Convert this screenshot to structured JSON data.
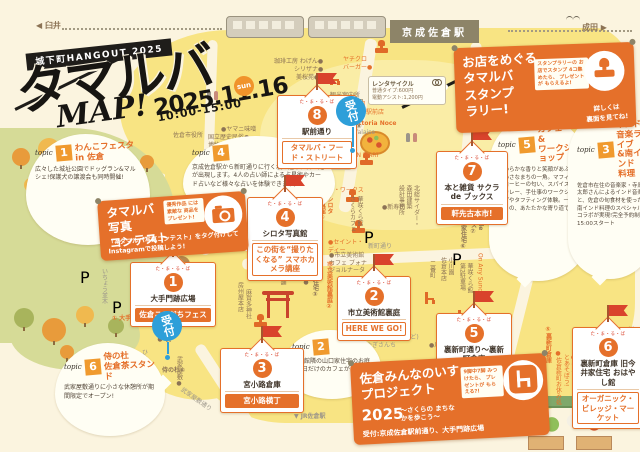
{
  "colors": {
    "accent_orange": "#E5702A",
    "flag_red": "#D9432C",
    "reception_blue": "#2E9FD9",
    "map_yellow": "#F8E483",
    "park_green": "#D6DB97",
    "station_khaki": "#8D8468",
    "ink": "#171512"
  },
  "header": {
    "badge": "城下町HANGOUT 2025",
    "title": "タマルバ",
    "map_word": "MAP!",
    "date": "2025.11.16",
    "day": "sun",
    "time": "10:00-15:00"
  },
  "stations": {
    "left": "◀ 臼井",
    "right": "成田 ▶",
    "keisei": "京成佐倉駅",
    "jr": "▼ JR佐倉駅"
  },
  "reception_label": "受付",
  "p_label": "P",
  "rental": {
    "title": "レンタサイクル",
    "line1": "普通タイプ:600円",
    "line2": "電動アシスト:1,200円"
  },
  "route_shield": "296",
  "stamp_rally": {
    "title": "お店をめぐる\nタマルバ\nスタンプ\nラリー!",
    "note": "スタンプラリーの\nお店でスタンプ\n4コ集めたら、\nプレゼントが\nもらえるよ!",
    "footer": "詳しくは\n裏面を見てね!"
  },
  "photo_contest": {
    "title": "タマルバ\n写真\nコンテスト",
    "note": "優秀作品\nには素敵な\n商品を\nプレゼント!",
    "body": "「#タマルバ写真コンテスト」をタグ付けしてInstagramで投稿しよう!"
  },
  "chair_project": {
    "title": "佐倉みんなのいす\nプロジェクト",
    "year": "2025",
    "sub": "〜さくらの\nまちなかを歩こう〜",
    "note": "9脚中7脚\nみつけたら、\nプレゼントが\nもらえる?!",
    "reception": "受付:京成佐倉駅前通り、大手門跡広場"
  },
  "venues": [
    {
      "num": "1",
      "tag": "た・ま・る・ば",
      "name": "大手門跡広場",
      "label": "佐倉こそだちフェス"
    },
    {
      "num": "2",
      "tag": "た・ま・る・ば",
      "name": "市立美術館裏庭",
      "label": "HERE WE GO!"
    },
    {
      "num": "3",
      "tag": "た・ま・る・ば",
      "name": "宮小路倉庫",
      "label": "宮小路横丁"
    },
    {
      "num": "4",
      "tag": "た・ま・る・ば",
      "name": "シロタ写真館",
      "label": "この街を“撮りたくなる” スマホカメラ講座"
    },
    {
      "num": "5",
      "tag": "た・ま・る・ば",
      "name": "裏新町通り〜裏新町倉庫",
      "label": "あそびのこみち"
    },
    {
      "num": "6",
      "tag": "た・ま・る・ば",
      "name": "裏新町倉庫 旧今井家住宅 おはやし館",
      "label": "オーガニック・ビレッジ・マーケット"
    },
    {
      "num": "7",
      "tag": "た・ま・る・ば",
      "name": "本と雑貨 サクラ de ブックス",
      "label": "軒先古本市!"
    },
    {
      "num": "8",
      "tag": "た・ま・る・ば",
      "name": "駅前通り",
      "label": "タマルバ・フード・ストリート"
    }
  ],
  "topics": [
    {
      "num": "1",
      "tag": "topic",
      "title": "わんこフェスタ\nin 佐倉",
      "body": "広々した城址公園でドッグラン&マルシェ!保護犬の譲渡会も同時開催!"
    },
    {
      "num": "2",
      "tag": "topic",
      "title": "",
      "body": "美術館隣の山口家住宅のお庭で1日だけのカフェがオープン!"
    },
    {
      "num": "3",
      "tag": "topic",
      "title": "インド\n音楽ライブ\n&南インド\n料理",
      "body": "佐倉市在住の音楽家・寺原太郎さんによるインド音楽と、佐倉の旬食材を使った南インド料理のスペシャルコラボが実現!完全予約制 15:00スタート"
    },
    {
      "num": "4",
      "tag": "topic",
      "title": "",
      "body": "京成佐倉駅から新町通りに行く坂の途中に占い処が出現します。4人の占い師による占星術やカード占いなど様々な占いを体験できます。"
    },
    {
      "num": "5",
      "tag": "topic",
      "title": "カフェ\n&\nワークショップ",
      "body": "やわらかな香りと笑顔があふれる小さなまちの一角。マフィンとコーヒーの匂い、スパイス香るカレー、手仕事のワークショップやタフティング体験。一日限りの、あたたかな寄り道です。"
    },
    {
      "num": "6",
      "tag": "topic",
      "title": "侍の杜\n佐倉茶スタンド",
      "body": "武家屋敷通りに小さな休憩所が期間限定でオープン!"
    }
  ],
  "map_labels": [
    {
      "t": "国立歴史民俗●\n博物館",
      "x": 208,
      "y": 134,
      "c": "brown"
    },
    {
      "t": "佐倉城址公園",
      "x": 250,
      "y": 162,
      "c": "brown"
    },
    {
      "t": "佐倉市役所",
      "x": 173,
      "y": 132,
      "c": "brown"
    },
    {
      "t": "●ヤマニ味噌",
      "x": 221,
      "y": 126,
      "c": "brown"
    },
    {
      "t": "珈琲工房 わげん●",
      "x": 274,
      "y": 58,
      "c": "brown"
    },
    {
      "t": "シリザナ●",
      "x": 294,
      "y": 66,
      "c": "brown"
    },
    {
      "t": "美桜苑●",
      "x": 296,
      "y": 74,
      "c": "brown"
    },
    {
      "t": "ヤチクロ\nバーガー●",
      "x": 343,
      "y": 56,
      "c": "orange"
    },
    {
      "t": "観光案内所",
      "x": 330,
      "y": 92,
      "c": "brown"
    },
    {
      "t": "●小川園\n 京成佐倉駅前店",
      "x": 342,
      "y": 101,
      "c": "orange"
    },
    {
      "t": "●Trattoria Noce",
      "x": 343,
      "y": 120,
      "c": "orange",
      "b": 1
    },
    {
      "t": "●la falaise",
      "x": 343,
      "y": 129,
      "c": "gray"
    },
    {
      "t": "●URON MART",
      "x": 338,
      "y": 152,
      "c": "orange"
    },
    {
      "t": "坂の途中の占い処 ④",
      "x": 289,
      "y": 158,
      "c": "brown",
      "box": 1
    },
    {
      "t": "じおん\nワーク・ワークス",
      "x": 316,
      "y": 179,
      "c": "orange"
    },
    {
      "t": "●新寿司",
      "x": 382,
      "y": 204,
      "c": "brown"
    },
    {
      "t": "華咲くら館\nさくらカフェ",
      "x": 348,
      "y": 196,
      "v": 1,
      "c": "brown"
    },
    {
      "t": "北総サイダー・\n森田建築\n設計事務所",
      "x": 397,
      "y": 185,
      "v": 1,
      "c": "brown"
    },
    {
      "t": "大津屋の\nピーナッツ",
      "x": 246,
      "y": 196,
      "v": 1,
      "c": "brown"
    },
    {
      "t": "●いちおか",
      "x": 252,
      "y": 249,
      "v": 1,
      "c": "brown"
    },
    {
      "t": "いちょう並木",
      "x": 100,
      "y": 268,
      "v": 1,
      "c": "gray"
    },
    {
      "t": "房州屋本店",
      "x": 236,
      "y": 282,
      "v": 1,
      "c": "brown"
    },
    {
      "t": "麻賀多神社",
      "x": 244,
      "y": 289,
      "v": 1,
      "c": "brown"
    },
    {
      "t": "●セイント・\n ディー",
      "x": 328,
      "y": 239,
      "c": "orange"
    },
    {
      "t": "新町通り",
      "x": 368,
      "y": 243,
      "c": "gray"
    },
    {
      "t": "●市立美術館\n カフェ ブォナ\n ジョルナータ",
      "x": 329,
      "y": 252,
      "c": "brown"
    },
    {
      "t": "山口家住宅③",
      "x": 311,
      "y": 261,
      "v": 1,
      "c": "brown",
      "b": 1
    },
    {
      "t": "市立美術館裏庭②",
      "x": 325,
      "y": 261,
      "v": 1,
      "c": "orange",
      "b": 1
    },
    {
      "t": "佐倉教会●",
      "x": 302,
      "y": 255,
      "v": 1,
      "c": "brown"
    },
    {
      "t": "蔵六餅本舗\n木村屋",
      "x": 271,
      "y": 255,
      "v": 1,
      "c": "brown"
    },
    {
      "t": "(ヤギはいないけど)\nやぎさんち",
      "x": 366,
      "y": 334,
      "c": "gray"
    },
    {
      "t": "●川魚割烹 玉家",
      "x": 429,
      "y": 342,
      "c": "brown"
    },
    {
      "t": "佐倉市民\n体育館●",
      "x": 156,
      "y": 318,
      "v": 1,
      "c": "brown"
    },
    {
      "t": "① 大手門跡広場",
      "x": 112,
      "y": 315,
      "c": "orange",
      "b": 1
    },
    {
      "t": "ひよどり坂",
      "x": 140,
      "y": 349,
      "v": 1,
      "c": "gray"
    },
    {
      "t": "侍の杜⑥",
      "x": 162,
      "y": 367,
      "c": "brown",
      "b": 1
    },
    {
      "t": "武家屋敷●",
      "x": 175,
      "y": 356,
      "v": 1,
      "c": "brown"
    },
    {
      "t": "武家屋敷通り",
      "x": 178,
      "y": 396,
      "c": "gray",
      "rot": 35
    },
    {
      "t": "⑤裏新町倉庫",
      "x": 544,
      "y": 326,
      "v": 1,
      "c": "orange",
      "b": 1
    },
    {
      "t": "●佐倉新町お休み処",
      "x": 554,
      "y": 350,
      "v": 1,
      "c": "orange"
    },
    {
      "t": "●牛乳パックおじさん\n とあそぼう!",
      "x": 562,
      "y": 354,
      "v": 1,
      "c": "orange"
    },
    {
      "t": "川瀬屋●",
      "x": 626,
      "y": 326,
      "v": 1,
      "c": "brown"
    },
    {
      "t": "二番町",
      "x": 428,
      "y": 260,
      "v": 1,
      "c": "brown"
    },
    {
      "t": "小川園\n佐倉本店",
      "x": 439,
      "y": 257,
      "v": 1,
      "c": "brown"
    },
    {
      "t": "華咲くら館\n第2駐車場",
      "x": 458,
      "y": 263,
      "v": 1,
      "c": "brown"
    },
    {
      "t": "On Any Sunday",
      "x": 476,
      "y": 253,
      "v": 1,
      "c": "orange"
    },
    {
      "t": "旧今井家住宅⑥",
      "x": 459,
      "y": 207,
      "v": 1,
      "c": "brown",
      "b": 1
    },
    {
      "t": "サクラde\nブックス⑦",
      "x": 469,
      "y": 204,
      "v": 1,
      "c": "brown",
      "b": 1
    },
    {
      "t": "シロタ\n写真館④",
      "x": 318,
      "y": 196,
      "v": 1,
      "c": "orange",
      "b": 1
    },
    {
      "t": "駅前通り⑧",
      "x": 355,
      "y": 99,
      "v": 1,
      "c": "brown",
      "b": 1
    },
    {
      "t": "加瀬武道具店●",
      "x": 589,
      "y": 205,
      "v": 1,
      "c": "brown"
    },
    {
      "t": "▼ JR佐倉駅",
      "x": 294,
      "y": 413,
      "c": "gray",
      "b": 1
    }
  ],
  "decor": [
    {
      "type": "stamp",
      "x": 375,
      "y": 48
    },
    {
      "type": "stamp",
      "x": 422,
      "y": 92
    },
    {
      "type": "stamp",
      "x": 360,
      "y": 160
    },
    {
      "type": "stamp",
      "x": 346,
      "y": 197
    },
    {
      "type": "stamp",
      "x": 256,
      "y": 256
    },
    {
      "type": "stamp",
      "x": 352,
      "y": 228
    },
    {
      "type": "stamp",
      "x": 254,
      "y": 322
    },
    {
      "type": "chair",
      "x": 330,
      "y": 73
    },
    {
      "type": "chair",
      "x": 425,
      "y": 292
    },
    {
      "type": "chair",
      "x": 604,
      "y": 228
    },
    {
      "type": "chair",
      "x": 286,
      "y": 266
    },
    {
      "type": "chair",
      "x": 458,
      "y": 310
    },
    {
      "type": "p",
      "x": 80,
      "y": 268
    },
    {
      "type": "p",
      "x": 112,
      "y": 298
    },
    {
      "type": "p",
      "x": 452,
      "y": 250
    },
    {
      "type": "p",
      "x": 364,
      "y": 228
    },
    {
      "type": "bird",
      "x": 115,
      "y": 146,
      "c": "#FFFFFF"
    },
    {
      "type": "bird",
      "x": 398,
      "y": 36,
      "c": "#FFFFFF"
    },
    {
      "type": "bird",
      "x": 566,
      "y": 16,
      "c": "#6B6456"
    },
    {
      "type": "people",
      "x": 405,
      "y": 130
    },
    {
      "type": "people",
      "x": 545,
      "y": 122
    },
    {
      "type": "people",
      "x": 206,
      "y": 88
    },
    {
      "type": "tree",
      "x": 12,
      "y": 148,
      "c": "#E89B3B",
      "s": 18
    },
    {
      "type": "tree",
      "x": 38,
      "y": 138,
      "c": "#F0B94F",
      "s": 22
    },
    {
      "type": "tree",
      "x": 68,
      "y": 150,
      "c": "#A8B45C",
      "s": 16
    },
    {
      "type": "tree",
      "x": 95,
      "y": 140,
      "c": "#E89B3B",
      "s": 20
    },
    {
      "type": "tree",
      "x": 24,
      "y": 178,
      "c": "#F0B94F",
      "s": 14
    },
    {
      "type": "tree",
      "x": 55,
      "y": 172,
      "c": "#E89B3B",
      "s": 18
    },
    {
      "type": "tree",
      "x": 85,
      "y": 182,
      "c": "#A8B45C",
      "s": 20
    },
    {
      "type": "tree",
      "x": 118,
      "y": 170,
      "c": "#F0B94F",
      "s": 16
    },
    {
      "type": "tree",
      "x": 140,
      "y": 155,
      "c": "#E89B3B",
      "s": 14
    },
    {
      "type": "tree",
      "x": 200,
      "y": 165,
      "c": "#F0B94F",
      "s": 16
    },
    {
      "type": "tree",
      "x": 218,
      "y": 188,
      "c": "#A8B45C",
      "s": 14
    },
    {
      "type": "tree",
      "x": 14,
      "y": 308,
      "c": "#A8B45C",
      "s": 20
    },
    {
      "type": "tree",
      "x": 42,
      "y": 318,
      "c": "#E89B3B",
      "s": 24
    },
    {
      "type": "tree",
      "x": 76,
      "y": 306,
      "c": "#F0B94F",
      "s": 18
    },
    {
      "type": "tree",
      "x": 108,
      "y": 318,
      "c": "#A8B45C",
      "s": 16
    },
    {
      "type": "tree",
      "x": 60,
      "y": 345,
      "c": "#E89B3B",
      "s": 14
    }
  ]
}
